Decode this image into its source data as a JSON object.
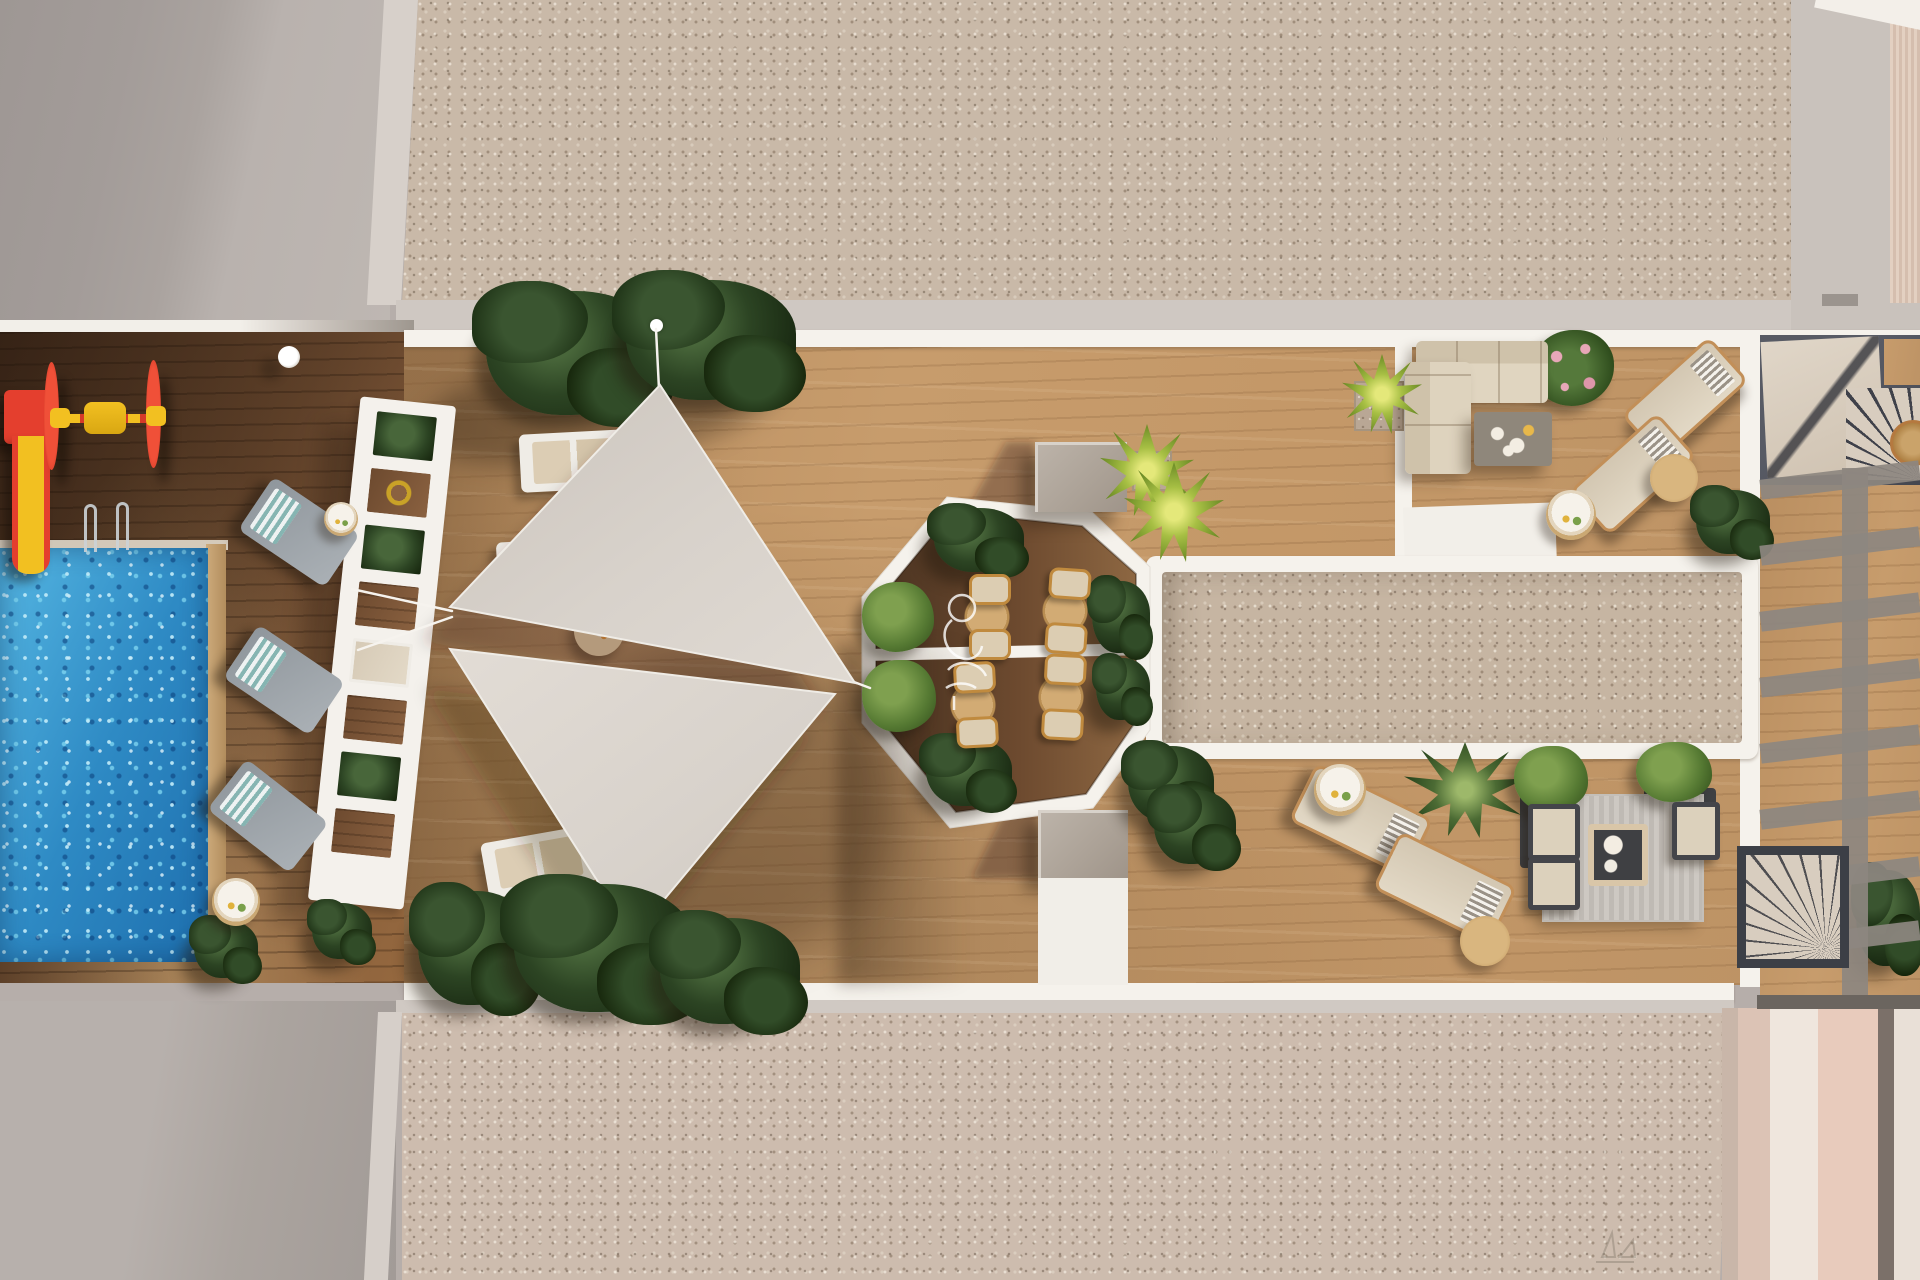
{
  "meta": {
    "title": "Rooftop amenity terrace — aerial top-down 3D architectural render",
    "render_style": "photorealistic plan view, afternoon sun, long shadows"
  },
  "palette": {
    "roof_concrete": "#b6aeaa",
    "roof_concrete_shadow": "#a19a97",
    "concrete_strip": "#d7d0ca",
    "gravel": "#c9b9a8",
    "gravel_warm": "#cdbcae",
    "deck_wood_light": "#c49868",
    "deck_wood_dark": "#6d4a2f",
    "pool_water": "#2e8ac4",
    "pool_sparkle": "#bdeafb",
    "white_trim": "#f5f2ec",
    "shade_sail": "#d8d2cb",
    "plant_dark_green": "#2c4423",
    "palm_green": "#a7bf44",
    "ivy_green": "#567a33",
    "play_red": "#e43f2e",
    "play_yellow": "#f2c021",
    "cushion_beige": "#dccdb2",
    "copper_frame": "#c28f58",
    "slate_dark": "#44464f",
    "stair_beige": "#d8cdbf"
  },
  "scene_inventory": {
    "pool": 1,
    "kids_playground_items": 2,
    "shade_sails": 2,
    "pergola_trellis": 1,
    "sun_loungers": 11,
    "octagon_dining_sets": 4,
    "sectional_sofa": 1,
    "lounge_armchair_set": 1,
    "side_tables": 9,
    "stairwells": 2,
    "gravel_courts": 2,
    "planters_and_bushes": 20,
    "pool_ladders": 2,
    "deck_lamp": 1
  },
  "items": [
    {
      "n": "plant-top-left",
      "t": "plant",
      "x": 486,
      "y": 291,
      "w": 176,
      "h": 124
    },
    {
      "n": "plant-top-right",
      "t": "plant",
      "x": 626,
      "y": 280,
      "w": 170,
      "h": 120
    },
    {
      "n": "plant-bottom-1",
      "t": "plant",
      "x": 418,
      "y": 891,
      "w": 116,
      "h": 114,
      "l": 7
    },
    {
      "n": "plant-bottom-2",
      "t": "plant",
      "x": 514,
      "y": 884,
      "w": 180,
      "h": 128,
      "l": 7
    },
    {
      "n": "plant-bottom-3",
      "t": "plant",
      "x": 660,
      "y": 918,
      "w": 140,
      "h": 106,
      "l": 7
    },
    {
      "n": "bush-poolside-1",
      "t": "plant",
      "x": 194,
      "y": 920,
      "w": 64,
      "h": 58
    },
    {
      "n": "bush-poolside-2",
      "t": "plant",
      "x": 312,
      "y": 903,
      "w": 60,
      "h": 56
    },
    {
      "n": "plant-court-1",
      "t": "plant",
      "x": 1128,
      "y": 746,
      "w": 86,
      "h": 76
    },
    {
      "n": "plant-court-2",
      "t": "plant",
      "x": 1154,
      "y": 790,
      "w": 82,
      "h": 74
    },
    {
      "n": "plant-sundeck-palm",
      "t": "palm-dark",
      "x": 1404,
      "y": 742,
      "w": 122,
      "h": 96
    },
    {
      "n": "bush-sofa-zone",
      "t": "plant",
      "x": 1696,
      "y": 490,
      "w": 74,
      "h": 64
    },
    {
      "n": "flower-bush-sofa",
      "t": "flower",
      "x": 1532,
      "y": 330,
      "w": 82,
      "h": 76
    },
    {
      "n": "planter-lounge-left",
      "t": "planter",
      "x": 1520,
      "y": 790,
      "w": 64,
      "h": 78,
      "l": 3
    },
    {
      "n": "planter-lounge-right",
      "t": "planter",
      "x": 1644,
      "y": 788,
      "w": 72,
      "h": 72,
      "l": 3
    },
    {
      "n": "lounge-rug",
      "t": "rug-striped",
      "x": 1544,
      "y": 796,
      "w": 158,
      "h": 124,
      "l": 3
    },
    {
      "n": "bush-lounge-left",
      "t": "ivy",
      "x": 1514,
      "y": 746,
      "w": 74,
      "h": 66
    },
    {
      "n": "bush-lounge-right",
      "t": "ivy",
      "x": 1636,
      "y": 742,
      "w": 76,
      "h": 60
    },
    {
      "n": "plant-right-edge",
      "t": "plant",
      "x": 1856,
      "y": 870,
      "w": 64,
      "h": 96
    },
    {
      "n": "octagon-bush-top",
      "t": "plant",
      "x": 934,
      "y": 508,
      "w": 90,
      "h": 64,
      "l": 5
    },
    {
      "n": "octagon-bush-right",
      "t": "plant",
      "x": 1092,
      "y": 581,
      "w": 58,
      "h": 72,
      "l": 5
    },
    {
      "n": "octagon-bush-bottom",
      "t": "plant",
      "x": 926,
      "y": 738,
      "w": 86,
      "h": 68,
      "l": 5
    },
    {
      "n": "octagon-bush-low-right",
      "t": "plant",
      "x": 1096,
      "y": 658,
      "w": 54,
      "h": 62,
      "l": 5
    },
    {
      "n": "octagon-ivy-1",
      "t": "ivy",
      "x": 862,
      "y": 582,
      "w": 72,
      "h": 70,
      "l": 5
    },
    {
      "n": "octagon-ivy-2",
      "t": "ivy",
      "x": 862,
      "y": 660,
      "w": 74,
      "h": 72,
      "l": 5
    },
    {
      "n": "palm-court-1",
      "t": "palm",
      "x": 1100,
      "y": 424,
      "w": 94,
      "h": 94,
      "l": 5
    },
    {
      "n": "palm-court-2",
      "t": "palm",
      "x": 1124,
      "y": 462,
      "w": 100,
      "h": 100,
      "l": 5
    },
    {
      "n": "palm-planter-top",
      "t": "palm",
      "x": 1342,
      "y": 354,
      "w": 80,
      "h": 80,
      "l": 5
    },
    {
      "n": "gravel-planter-top",
      "t": "gravelsq",
      "x": 1354,
      "y": 381,
      "w": 50,
      "h": 50
    },
    {
      "n": "gravel-planter-court",
      "t": "gravelsq",
      "x": 1132,
      "y": 451,
      "w": 40,
      "h": 40
    },
    {
      "n": "lounger-pool-1",
      "t": "lounger-gray",
      "x": 247,
      "y": 500,
      "w": 104,
      "h": 64,
      "r": 34
    },
    {
      "n": "lounger-pool-2",
      "t": "lounger-gray",
      "x": 232,
      "y": 648,
      "w": 104,
      "h": 64,
      "r": 34
    },
    {
      "n": "lounger-pool-3",
      "t": "lounger-gray",
      "x": 216,
      "y": 784,
      "w": 104,
      "h": 64,
      "r": 38
    },
    {
      "n": "lounger-deck-1",
      "t": "lounger-white",
      "x": 520,
      "y": 432,
      "w": 108,
      "h": 58,
      "r": -3
    },
    {
      "n": "lounger-deck-2",
      "t": "lounger-white",
      "x": 497,
      "y": 540,
      "w": 100,
      "h": 48,
      "r": -3
    },
    {
      "n": "lounger-deck-3",
      "t": "lounger-white",
      "x": 484,
      "y": 834,
      "w": 110,
      "h": 56,
      "r": -10
    },
    {
      "n": "lounger-sofazone-1",
      "t": "lounger-beige",
      "x": 1626,
      "y": 368,
      "w": 118,
      "h": 60,
      "r": -42
    },
    {
      "n": "lounger-sofazone-2",
      "t": "lounger-beige",
      "x": 1574,
      "y": 444,
      "w": 118,
      "h": 60,
      "r": -42
    },
    {
      "n": "lounger-sundeck-1",
      "t": "lounger-beige",
      "x": 1296,
      "y": 788,
      "w": 130,
      "h": 64,
      "r": 26
    },
    {
      "n": "lounger-sundeck-2",
      "t": "lounger-beige",
      "x": 1380,
      "y": 856,
      "w": 130,
      "h": 64,
      "r": 26
    },
    {
      "n": "side-table-pool-1",
      "t": "table-tray",
      "x": 324,
      "y": 502,
      "w": 34,
      "h": 34
    },
    {
      "n": "side-table-pool-2",
      "t": "table-tray",
      "x": 212,
      "y": 878,
      "w": 48,
      "h": 48
    },
    {
      "n": "side-table-deck",
      "t": "table-tray",
      "x": 544,
      "y": 498,
      "w": 36,
      "h": 36
    },
    {
      "n": "serving-platform",
      "t": "platform",
      "x": 574,
      "y": 606,
      "w": 50,
      "h": 50
    },
    {
      "n": "side-table-sofazone-1",
      "t": "table-wood",
      "x": 1650,
      "y": 454,
      "w": 48,
      "h": 48
    },
    {
      "n": "side-table-sofazone-2",
      "t": "table-tray",
      "x": 1546,
      "y": 490,
      "w": 50,
      "h": 50
    },
    {
      "n": "side-table-sundeck-1",
      "t": "table-tray",
      "x": 1314,
      "y": 764,
      "w": 52,
      "h": 52
    },
    {
      "n": "side-table-sundeck-2",
      "t": "table-wood",
      "x": 1460,
      "y": 916,
      "w": 50,
      "h": 50
    },
    {
      "n": "side-table-stairs",
      "t": "table-copper",
      "x": 1890,
      "y": 420,
      "w": 46,
      "h": 46
    },
    {
      "n": "dining-set-1",
      "t": "dineset",
      "x": 962,
      "y": 576,
      "w": 50,
      "h": 82,
      "l": 5
    },
    {
      "n": "dining-set-2",
      "t": "dineset",
      "x": 1040,
      "y": 570,
      "w": 50,
      "h": 82,
      "l": 5,
      "r": 4
    },
    {
      "n": "dining-set-3",
      "t": "dineset",
      "x": 948,
      "y": 664,
      "w": 50,
      "h": 82,
      "l": 5,
      "r": -3
    },
    {
      "n": "dining-set-4",
      "t": "dineset",
      "x": 1036,
      "y": 656,
      "w": 50,
      "h": 82,
      "l": 5,
      "r": 3
    },
    {
      "n": "sofa-seat",
      "t": "sofa-h",
      "x": 1416,
      "y": 341,
      "w": 132,
      "h": 62
    },
    {
      "n": "sofa-chaise",
      "t": "sofa-v",
      "x": 1405,
      "y": 362,
      "w": 66,
      "h": 112
    },
    {
      "n": "coffee-table-sofa",
      "t": "ctable-dark",
      "x": 1474,
      "y": 412,
      "w": 78,
      "h": 54
    },
    {
      "n": "armchair-lounge-1",
      "t": "chair-dark",
      "x": 1528,
      "y": 804,
      "w": 52,
      "h": 56
    },
    {
      "n": "armchair-lounge-2",
      "t": "chair-dark",
      "x": 1528,
      "y": 858,
      "w": 52,
      "h": 52
    },
    {
      "n": "bench-lounge",
      "t": "chair-dark",
      "x": 1672,
      "y": 802,
      "w": 48,
      "h": 58
    },
    {
      "n": "coffee-table-lounge",
      "t": "table-sqwood",
      "x": 1588,
      "y": 824,
      "w": 60,
      "h": 62
    },
    {
      "n": "pool-lamp",
      "t": "lamp",
      "x": 278,
      "y": 346,
      "w": 22,
      "h": 22
    },
    {
      "n": "sail-pole-top",
      "t": "pole",
      "x": 650,
      "y": 319,
      "w": 13,
      "h": 13
    },
    {
      "n": "roof-vent-mark",
      "t": "mark",
      "x": 1822,
      "y": 294,
      "w": 36,
      "h": 12
    },
    {
      "n": "pergola-beam-vertical",
      "t": "beam",
      "x": 1842,
      "y": 468,
      "w": 26,
      "h": 527
    },
    {
      "n": "pergola-shadow-beam-1",
      "t": "beam",
      "x": 1760,
      "y": 470,
      "w": 160,
      "h": 20,
      "r": -7
    },
    {
      "n": "pergola-shadow-beam-2",
      "t": "beam",
      "x": 1760,
      "y": 536,
      "w": 160,
      "h": 20,
      "r": -7
    },
    {
      "n": "pergola-shadow-beam-3",
      "t": "beam",
      "x": 1760,
      "y": 602,
      "w": 160,
      "h": 20,
      "r": -7
    },
    {
      "n": "pergola-shadow-beam-4",
      "t": "beam",
      "x": 1760,
      "y": 668,
      "w": 160,
      "h": 20,
      "r": -7
    },
    {
      "n": "pergola-shadow-beam-5",
      "t": "beam",
      "x": 1760,
      "y": 734,
      "w": 160,
      "h": 20,
      "r": -7
    },
    {
      "n": "pergola-shadow-beam-6",
      "t": "beam",
      "x": 1760,
      "y": 800,
      "w": 160,
      "h": 20,
      "r": -7
    },
    {
      "n": "pergola-shadow-beam-7",
      "t": "beam",
      "x": 1760,
      "y": 866,
      "w": 160,
      "h": 20,
      "r": -7
    },
    {
      "n": "pergola-shadow-beam-8",
      "t": "beam",
      "x": 1760,
      "y": 930,
      "w": 160,
      "h": 20,
      "r": -7
    }
  ]
}
